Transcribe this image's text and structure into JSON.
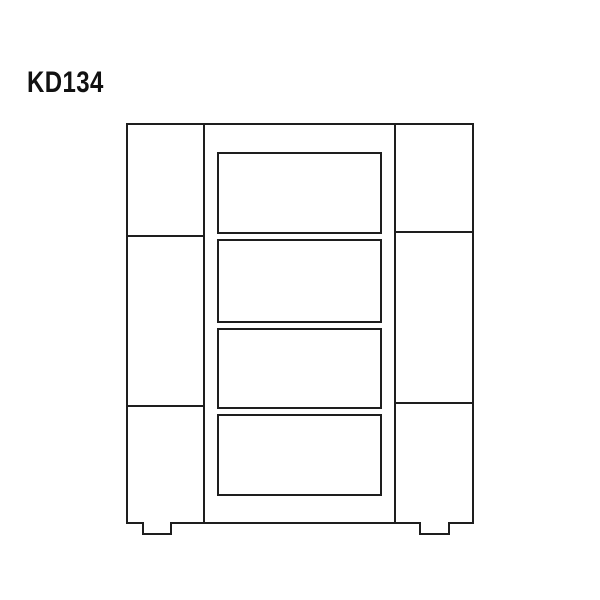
{
  "page": {
    "background": "#ffffff",
    "line_color": "#1e1e1e",
    "text_color": "#111111"
  },
  "figure": {
    "label": "KD134"
  },
  "diagram": {
    "type": "furniture-line-drawing",
    "viewbox": "0 0 600 600",
    "stroke": "#1e1e1e",
    "stroke_width": 2,
    "outline": {
      "x1": 127,
      "y1": 124,
      "x2": 473,
      "y2": 523
    },
    "feet": [
      {
        "x1": 143,
        "x2": 171,
        "drop": 11
      },
      {
        "x1": 420,
        "x2": 449,
        "drop": 11
      }
    ],
    "verticals": [
      204,
      395
    ],
    "left_dividers": [
      236,
      406
    ],
    "right_dividers": [
      232,
      403
    ],
    "drawers": [
      {
        "x": 218,
        "y": 153,
        "w": 163,
        "h": 80
      },
      {
        "x": 218,
        "y": 240,
        "w": 163,
        "h": 82
      },
      {
        "x": 218,
        "y": 329,
        "w": 163,
        "h": 79
      },
      {
        "x": 218,
        "y": 415,
        "w": 163,
        "h": 80
      }
    ]
  }
}
